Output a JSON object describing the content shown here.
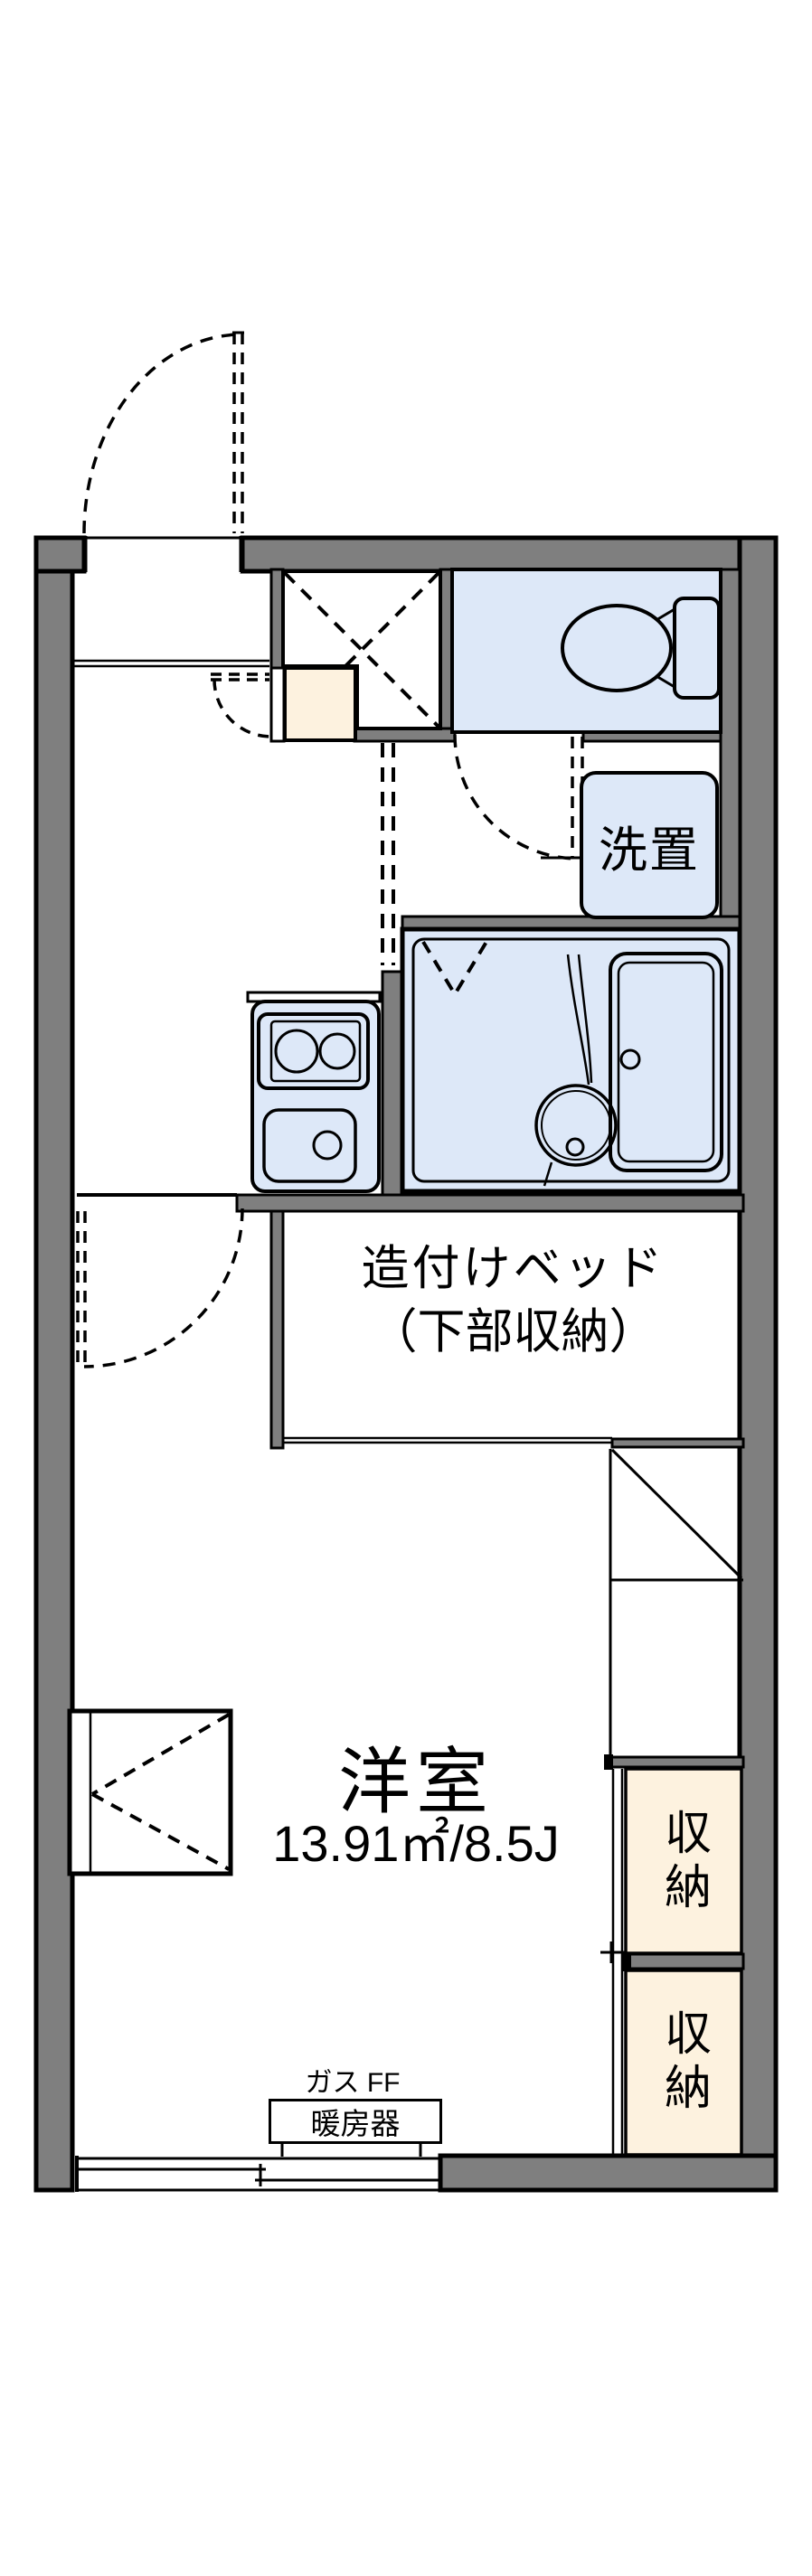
{
  "plan_type": "apartment-floor-plan",
  "rooms": {
    "laundry_label": "洗置",
    "bed_label_line1": "造付けベッド",
    "bed_label_line2": "（下部収納）",
    "main_room_name": "洋室",
    "main_room_size": "13.91㎡/8.5J",
    "storage_upper_label": "収納",
    "storage_lower_label": "収納"
  },
  "heater": {
    "caption": "ガス FF",
    "label": "暖房器"
  },
  "colors": {
    "wall_gray": "#7f7f7f",
    "wet_area_blue": "#dde8f8",
    "genkan_cream": "#fdf2df",
    "storage_cream": "#fdf2df",
    "line_black": "#000000",
    "background_white": "#ffffff"
  }
}
